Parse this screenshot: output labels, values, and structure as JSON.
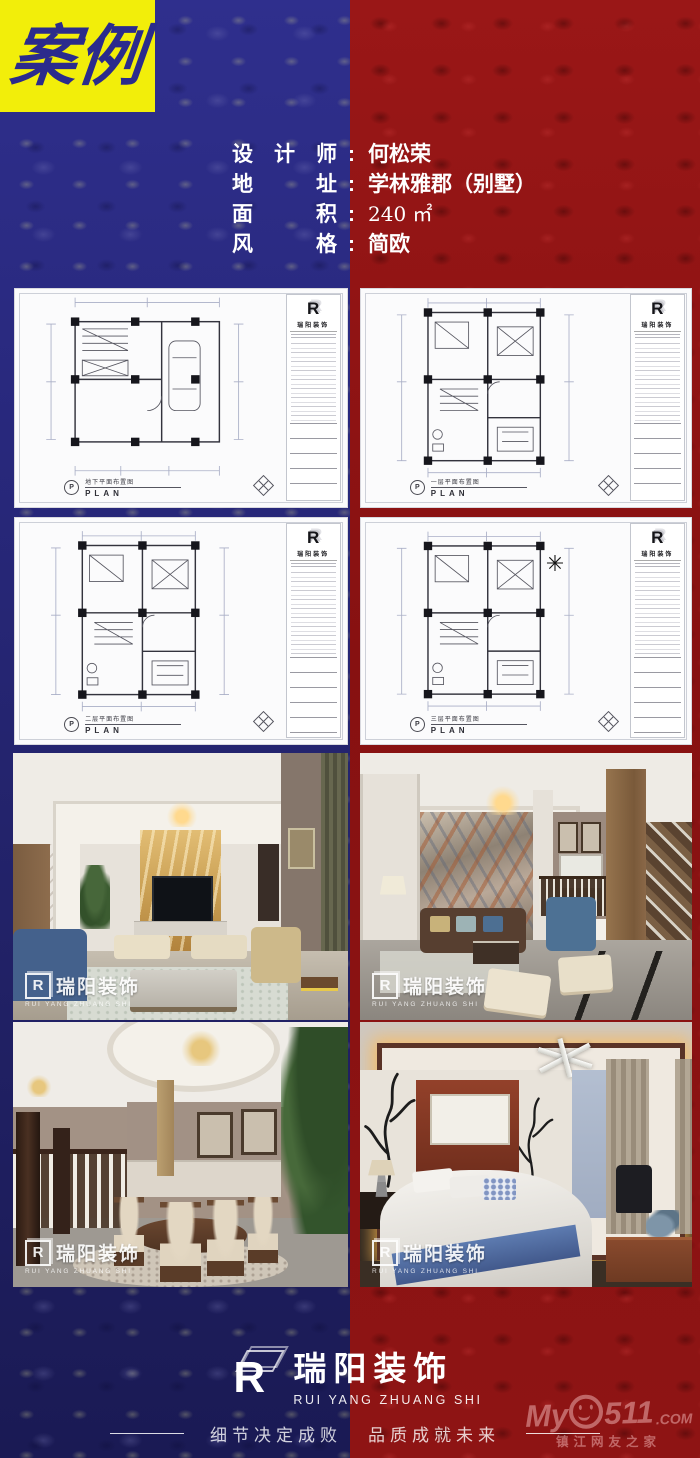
{
  "badge": {
    "text": "案例"
  },
  "info": {
    "colon": ":",
    "rows": [
      {
        "label": "设　计　师",
        "value": "何松荣"
      },
      {
        "label": "地　　　址",
        "value": "学林雅郡（别墅）"
      },
      {
        "label": "面　　　积",
        "value": "240 ㎡"
      },
      {
        "label": "风　　　格",
        "value": "简欧"
      }
    ]
  },
  "logo_letter": "R",
  "plans": [
    {
      "title_cn": "地下平面布置图",
      "title_en": "PLAN",
      "marker": "P",
      "company": "瑞阳装饰"
    },
    {
      "title_cn": "一层平面布置图",
      "title_en": "PLAN",
      "marker": "P",
      "company": "瑞阳装饰"
    },
    {
      "title_cn": "二层平面布置图",
      "title_en": "PLAN",
      "marker": "P",
      "company": "瑞阳装饰"
    },
    {
      "title_cn": "三层平面布置图",
      "title_en": "PLAN",
      "marker": "P",
      "company": "瑞阳装饰",
      "symbol": "✳"
    }
  ],
  "watermark": {
    "cn": "瑞阳装饰",
    "en": "RUI YANG ZHUANG SHI"
  },
  "photos": [
    {
      "subject": "living-room-gold-marble-tv-wall"
    },
    {
      "subject": "living-room-marble-feature-wall-staircase"
    },
    {
      "subject": "dining-room-round-table"
    },
    {
      "subject": "bedroom-new-chinese-style"
    }
  ],
  "footer": {
    "brand_cn": "瑞阳装饰",
    "brand_en": "RUI YANG ZHUANG SHI",
    "slogan_left": "细节决定成败",
    "slogan_right": "品质成就未来",
    "site": {
      "prefix": "My",
      "digits": "511",
      "tld": ".COM",
      "sub": "镇江网友之家"
    }
  },
  "colors": {
    "badge_bg": "#f2ee0a",
    "badge_text": "#2b2b8c",
    "left_bg": "#23237a",
    "right_bg": "#8e1414",
    "text": "#ffffff"
  }
}
